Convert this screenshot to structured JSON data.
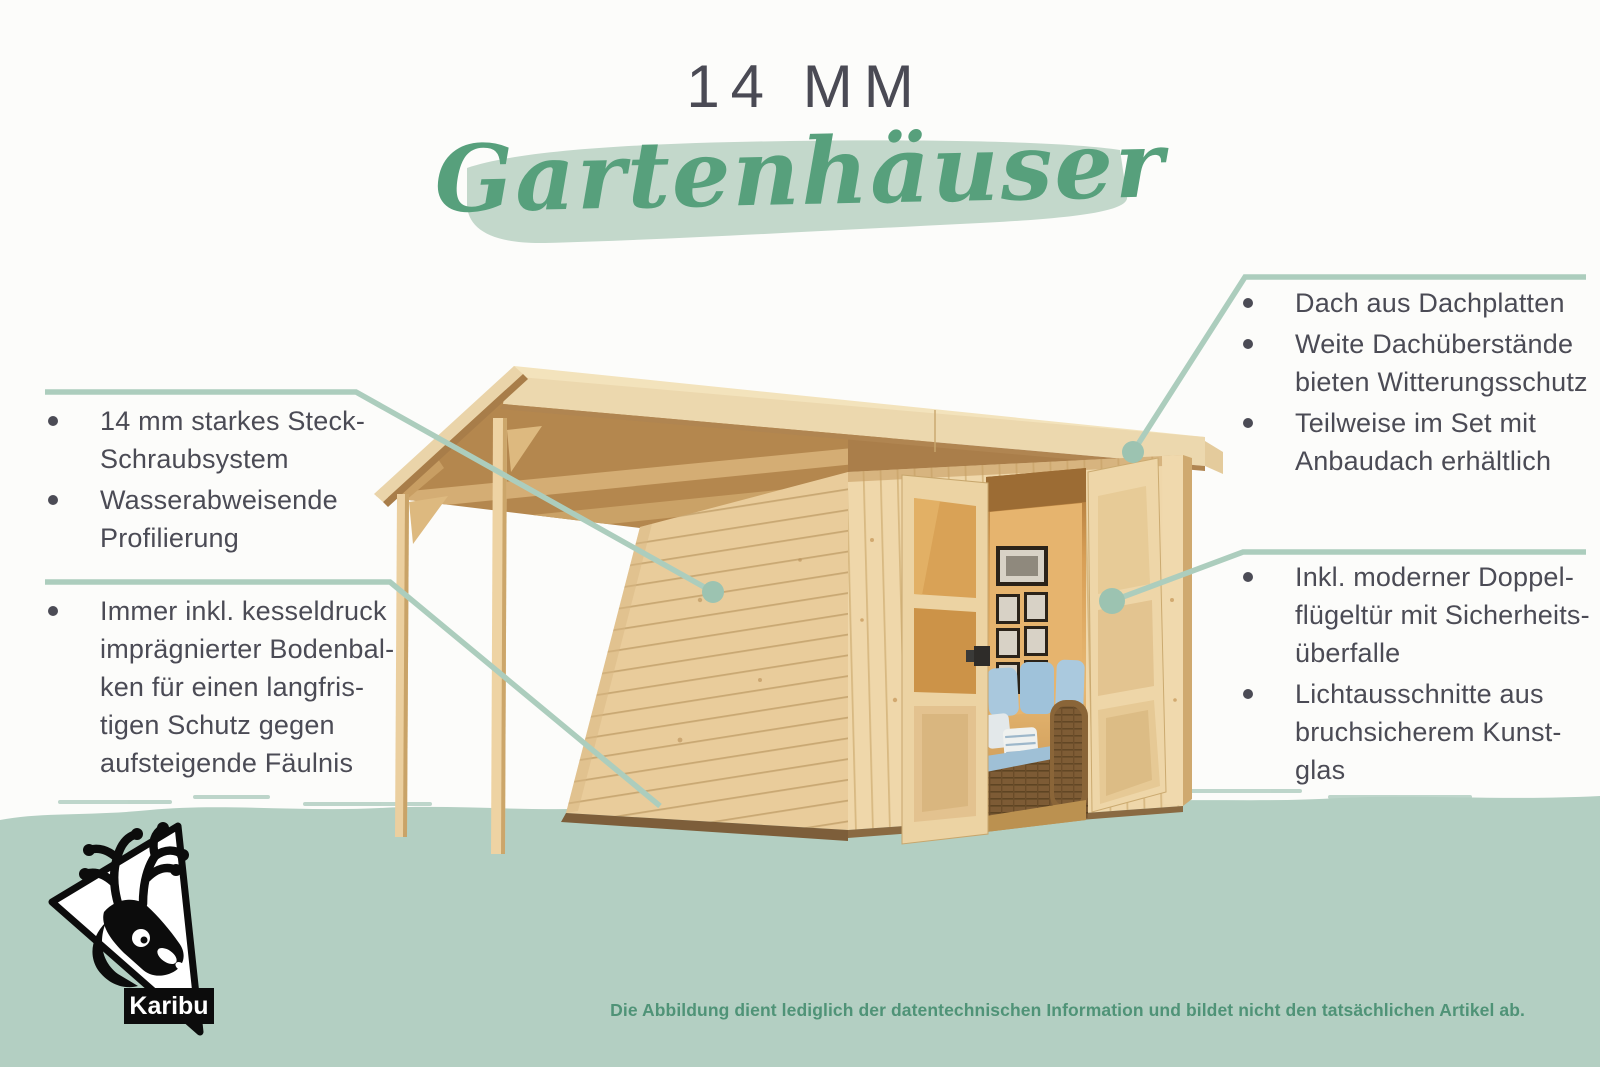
{
  "header": {
    "thickness_label": "14 MM",
    "script_title": "Gartenhäuser"
  },
  "callouts": {
    "left_top": {
      "items": [
        "14 mm starkes Steck-\nSchraubsystem",
        "Wasserabweisende\nProfilierung"
      ]
    },
    "left_bottom": {
      "items": [
        "Immer inkl. kesseldruck\nimprägnierter Bodenbal-\nken für einen langfris-\ntigen Schutz gegen\naufsteigende Fäulnis"
      ]
    },
    "right_top": {
      "items": [
        "Dach aus Dachplatten",
        "Weite Dachüberstände\nbieten Witterungsschutz",
        "Teilweise im Set mit\nAnbaudach erhältlich"
      ]
    },
    "right_bottom": {
      "items": [
        "Inkl. moderner Doppel-\nflügeltür mit Sicherheits-\nüberfalle",
        "Lichtausschnitte aus\nbruchsicherem Kunst-\nglas"
      ]
    }
  },
  "logo": {
    "brand": "Karibu",
    "icon": "caribou-deer-icon"
  },
  "footer": {
    "disclaimer": "Die Abbildung dient lediglich der datentechnischen Information und bildet nicht den tatsächlichen Artikel ab."
  },
  "colors": {
    "accent_green": "#57a07c",
    "brush_green": "#c3d8cb",
    "band_green": "#b3cfc2",
    "callout_line_green": "#accdbd",
    "callout_dot_green": "#9cc3b1",
    "text_dark": "#4b4b55",
    "disclaimer_green": "#4f9377"
  }
}
